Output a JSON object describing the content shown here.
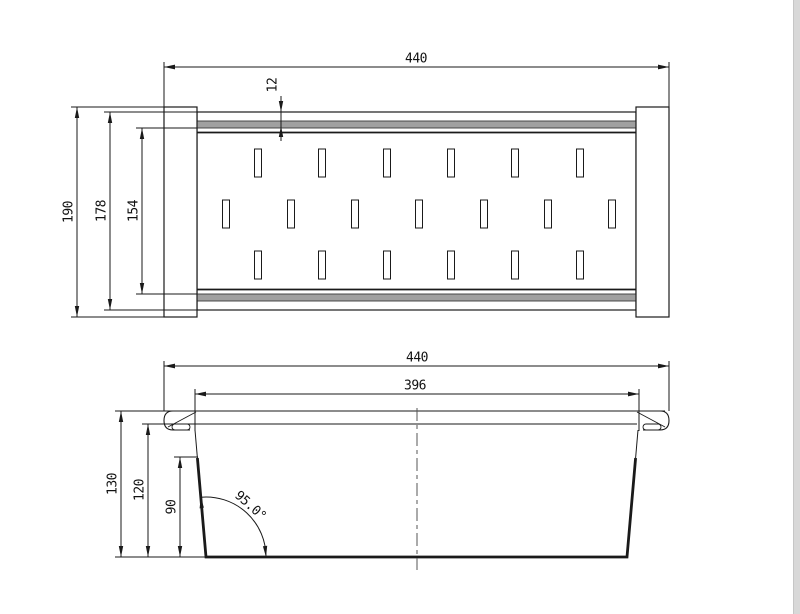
{
  "drawing": {
    "top_view": {
      "width": "440",
      "rim_offset": "12",
      "outer_height": "190",
      "body_height": "178",
      "inner_height": "154",
      "slot_rows": [
        6,
        7,
        6
      ]
    },
    "side_view": {
      "overall_width": "440",
      "inner_width": "396",
      "overall_height": "130",
      "body_height": "120",
      "wall_height": "90",
      "wall_angle": "95.0°"
    },
    "colors": {
      "line": "#1a1a1a",
      "rolled_edge_fill": "#a0a0a0",
      "page_edge": "#d8d8d8"
    }
  }
}
